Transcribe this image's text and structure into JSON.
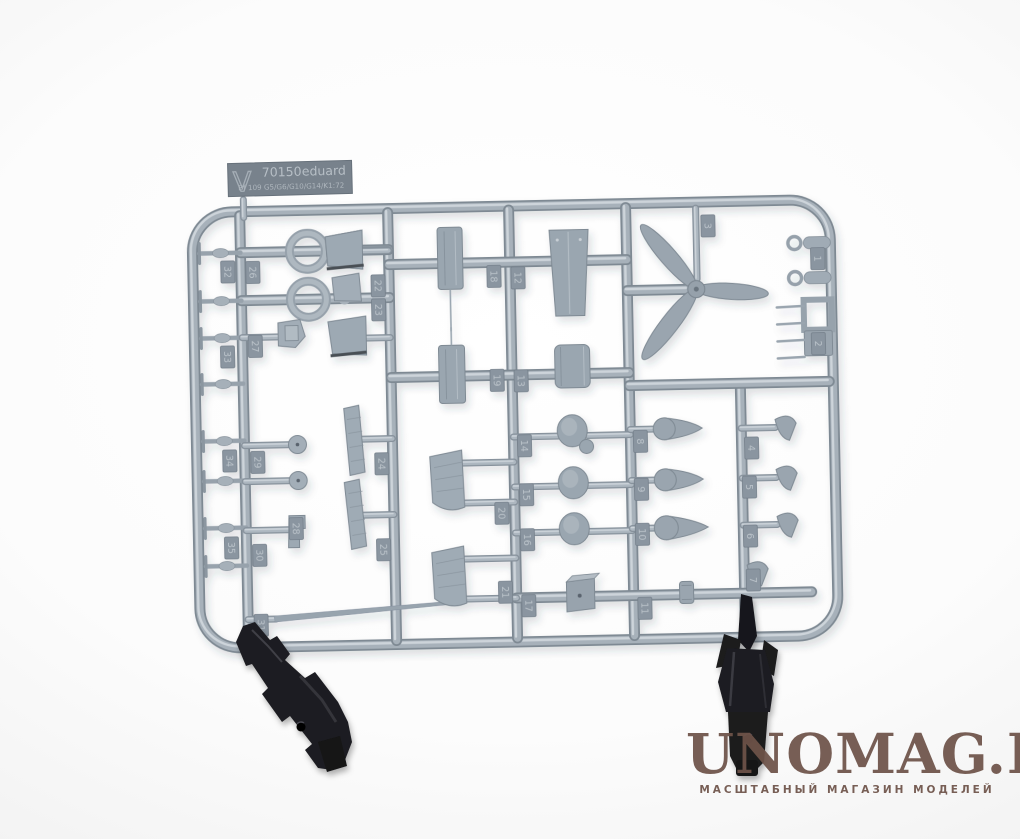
{
  "photo": {
    "background_color": "#f1f1f1",
    "subject": "injection-molded model kit sprue photo"
  },
  "sprue": {
    "plastic_color": "#a7b1ba",
    "plastic_shadow_color": "#7e8993",
    "plastic_highlight_color": "#cdd4da",
    "tag": {
      "sprue_letter": "V",
      "number": "70150",
      "brand": "eduard",
      "variants": "Bf 109 G5/G6/G10/G14/K",
      "scale": "1:72"
    },
    "part_numbers": [
      {
        "n": "1",
        "x": 821,
        "y": 265
      },
      {
        "n": "2",
        "x": 820,
        "y": 350
      },
      {
        "n": "3",
        "x": 712,
        "y": 230
      },
      {
        "n": "4",
        "x": 751,
        "y": 453
      },
      {
        "n": "5",
        "x": 748,
        "y": 492
      },
      {
        "n": "6",
        "x": 748,
        "y": 541
      },
      {
        "n": "7",
        "x": 750,
        "y": 585
      },
      {
        "n": "8",
        "x": 640,
        "y": 444
      },
      {
        "n": "9",
        "x": 640,
        "y": 492
      },
      {
        "n": "10",
        "x": 640,
        "y": 537
      },
      {
        "n": "11",
        "x": 641,
        "y": 611
      },
      {
        "n": "12",
        "x": 521,
        "y": 278
      },
      {
        "n": "13",
        "x": 522,
        "y": 381
      },
      {
        "n": "14",
        "x": 524,
        "y": 446
      },
      {
        "n": "15",
        "x": 525,
        "y": 495
      },
      {
        "n": "16",
        "x": 525,
        "y": 540
      },
      {
        "n": "17",
        "x": 525,
        "y": 606
      },
      {
        "n": "18",
        "x": 497,
        "y": 276
      },
      {
        "n": "19",
        "x": 498,
        "y": 380
      },
      {
        "n": "20",
        "x": 500,
        "y": 513
      },
      {
        "n": "21",
        "x": 502,
        "y": 592
      },
      {
        "n": "22",
        "x": 381,
        "y": 283
      },
      {
        "n": "23",
        "x": 381,
        "y": 307
      },
      {
        "n": "24",
        "x": 381,
        "y": 461
      },
      {
        "n": "25",
        "x": 381,
        "y": 547
      },
      {
        "n": "26",
        "x": 256,
        "y": 267
      },
      {
        "n": "27",
        "x": 257,
        "y": 341
      },
      {
        "n": "28",
        "x": 294,
        "y": 524
      },
      {
        "n": "29",
        "x": 257,
        "y": 457
      },
      {
        "n": "30",
        "x": 257,
        "y": 550
      },
      {
        "n": "31",
        "x": 257,
        "y": 620
      },
      {
        "n": "32",
        "x": 231,
        "y": 266
      },
      {
        "n": "33",
        "x": 229,
        "y": 351
      },
      {
        "n": "34",
        "x": 229,
        "y": 455
      },
      {
        "n": "35",
        "x": 229,
        "y": 542
      }
    ],
    "tab_fill": "#8a95a0",
    "tab_text_color": "#bac2c9"
  },
  "clips": {
    "color": "#1d1d20",
    "count": 2
  },
  "watermark": {
    "title": "UNOMAG.RU",
    "subtitle": "МАСШТАБНЫЙ МАГАЗИН МОДЕЛЕЙ",
    "color": "#6e5349"
  }
}
